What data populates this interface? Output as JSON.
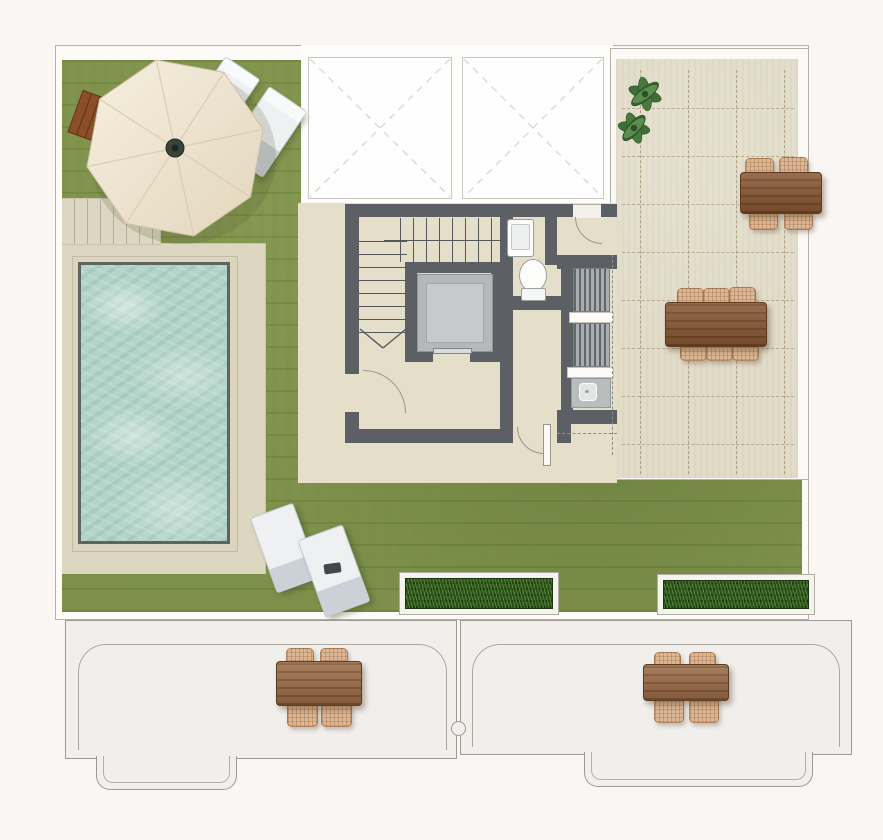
{
  "plan": {
    "type": "roof-terrace-floor-plan",
    "palette": {
      "background": "#faf6f3",
      "grass": "#7e914c",
      "paving": "#ddd7c2",
      "terrace_tile": "#e1dbc8",
      "core_floor": "#e5dec8",
      "wall": "#5c6064",
      "water": "#b2d4c9",
      "wood": "#875531",
      "wicker": "#dcb795",
      "lower_floor": "#f1efec",
      "planter_green": "#2a4a1d",
      "umbrella": "#f1e8d6"
    },
    "areas": {
      "garden": {
        "label": "Lawn garden"
      },
      "pool": {
        "label": "Swimming pool"
      },
      "pool_deck": {
        "label": "Pool deck with steps"
      },
      "skylights": {
        "label": "Skylights",
        "count": 2
      },
      "core": {
        "label": "Stair and elevator core"
      },
      "stairs": {
        "label": "Staircase"
      },
      "elevator": {
        "label": "Elevator"
      },
      "wc": {
        "label": "WC"
      },
      "kitchenette": {
        "label": "Outdoor kitchenette"
      },
      "roof_terrace": {
        "label": "Tiled roof terrace"
      },
      "lower_terrace_left": {
        "label": "Lower terrace left"
      },
      "lower_terrace_right": {
        "label": "Lower terrace right"
      }
    },
    "furniture": {
      "umbrella": {
        "label": "Parasol with wooden base"
      },
      "loungers_top": {
        "label": "Sun loungers by parasol",
        "count": 2
      },
      "loungers_bottom": {
        "label": "Sun loungers on lawn",
        "count": 2
      },
      "dining_table_4": {
        "label": "Dining table with 4 chairs"
      },
      "dining_table_6": {
        "label": "Dining table with 6 chairs"
      },
      "lower_table_left": {
        "label": "Terrace table with 4 chairs"
      },
      "lower_table_right": {
        "label": "Terrace table with 4 chairs"
      },
      "planters": {
        "label": "Planter boxes",
        "count": 2
      },
      "plants": {
        "label": "Green plants",
        "count": 2
      },
      "toilet": {
        "label": "Toilet"
      },
      "basin": {
        "label": "Hand basin"
      },
      "sink": {
        "label": "Kitchen sink"
      },
      "louvered_units": {
        "label": "Louvered appliance units",
        "count": 2
      }
    }
  }
}
